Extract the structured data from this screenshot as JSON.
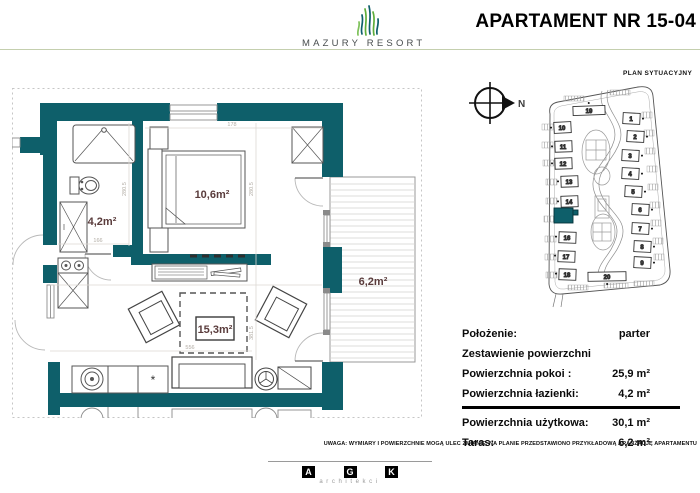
{
  "header": {
    "brand": "MAZURY RESORT",
    "title": "APARTAMENT NR 15-04"
  },
  "floor_plan": {
    "rooms": {
      "bathroom": "4,2m²",
      "bedroom": "10,6m²",
      "living": "15,3m²",
      "terrace": "6,2m²"
    },
    "dimension_labels": [
      "178",
      "280.5",
      "280.5",
      "166",
      "556",
      "381.5"
    ]
  },
  "site_plan": {
    "title": "PLAN SYTUACYJNY",
    "compass_label": "N",
    "highlighted_building": "15",
    "buildings": [
      "1",
      "2",
      "3",
      "4",
      "5",
      "6",
      "7",
      "8",
      "9",
      "10",
      "11",
      "12",
      "13",
      "14",
      "15",
      "16",
      "17",
      "18",
      "19",
      "20"
    ]
  },
  "details_table": {
    "rows": [
      {
        "label": "Położenie:",
        "value": "parter"
      },
      {
        "label": "Zestawienie powierzchni",
        "value": ""
      },
      {
        "label": "Powierzchnia pokoi :",
        "value": "25,9 m²"
      },
      {
        "label": "Powierzchnia łazienki:",
        "value": "4,2 m²"
      },
      {
        "label": "Powierzchnia użytkowa:",
        "value": "30,1 m²"
      },
      {
        "label": "Taras:",
        "value": "6,2 m²"
      }
    ]
  },
  "footer": {
    "disclaimer": "UWAGA: WYMIARY I POWIERZCHNIE MOGĄ ULEC ZMIANIE, NA PLANIE PRZEDSTAWIONO PRZYKŁADOWĄ ARANŻACJĘ APARTAMENTU",
    "architects": {
      "letters": [
        "A",
        "G",
        "K"
      ],
      "caption": "architekci"
    }
  },
  "colors": {
    "wall_teal": "#0e5f6a",
    "room_label": "#5a3c3c",
    "dim_gray": "#b2aca4",
    "header_line": "#c4cfae",
    "logo_green": "#5fae3a"
  }
}
